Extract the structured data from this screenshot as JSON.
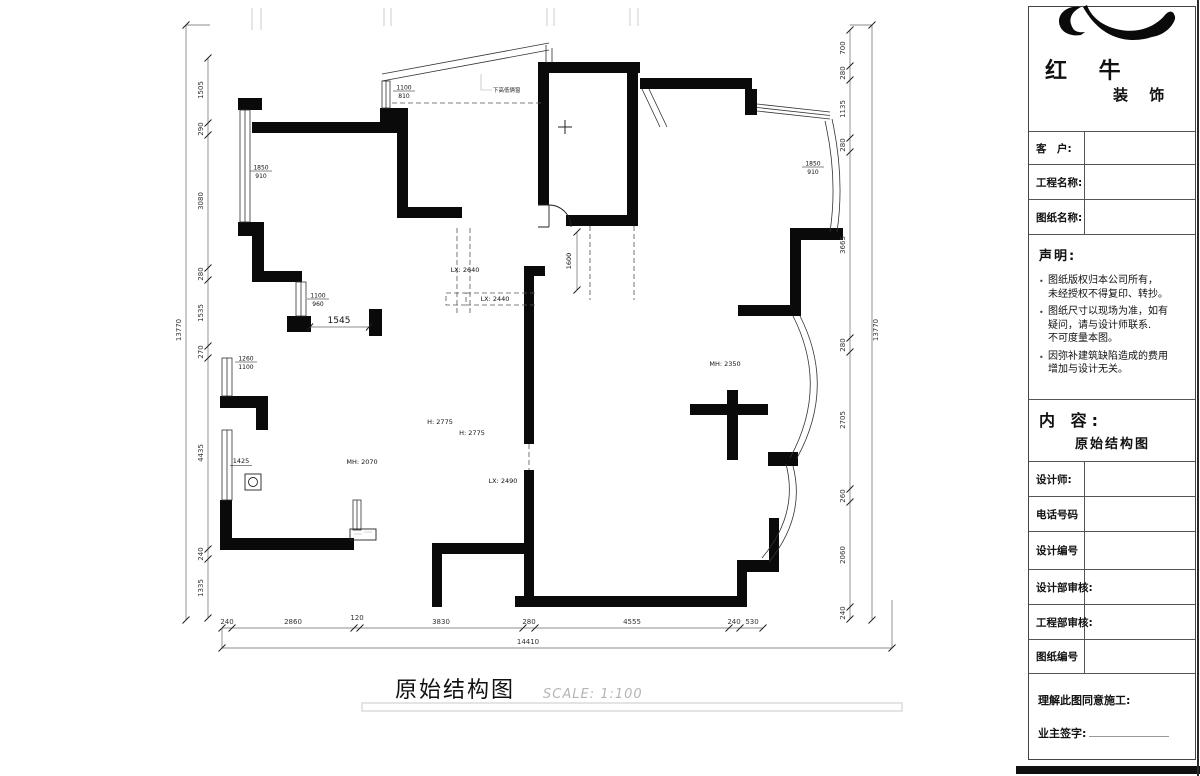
{
  "title_block": {
    "brand": {
      "name_line1": "红 牛",
      "name_line2": "装 饰"
    },
    "fields": [
      {
        "label": "客　户:"
      },
      {
        "label": "工程名称:"
      },
      {
        "label": "图纸名称:"
      }
    ],
    "statement": {
      "heading": "声明:",
      "items": [
        [
          "图纸版权归本公司所有，",
          "未经授权不得复印、转抄。"
        ],
        [
          "图纸尺寸以现场为准，如有",
          "疑问，请与设计师联系.",
          "不可度量本图。"
        ],
        [
          "因弥补建筑缺陷造成的费用",
          "增加与设计无关。"
        ]
      ]
    },
    "content": {
      "heading": "内 容:",
      "value": "原始结构图"
    },
    "rows": [
      {
        "label": "设计师:"
      },
      {
        "label": "电话号码"
      },
      {
        "label": "设计编号"
      },
      {
        "label": "设计部审核:"
      },
      {
        "label": "工程部审核:"
      },
      {
        "label": "图纸编号"
      }
    ],
    "footer": {
      "agree": "理解此图同意施工:",
      "sign": "业主签字:"
    }
  },
  "drawing": {
    "title": "原始结构图",
    "scale_note": "SCALE: 1:100",
    "dims": {
      "left_total": "13770",
      "left": [
        "1505",
        "290",
        "3080",
        "280",
        "1535",
        "270",
        "4435",
        "240",
        "1335"
      ],
      "right_total": "13770",
      "right": [
        "700",
        "280",
        "1135",
        "280",
        "3665",
        "280",
        "2705",
        "260",
        "2060",
        "240"
      ],
      "bottom_total": "14410",
      "bottom": [
        "240",
        "2860",
        "120",
        "3830",
        "280",
        "4555",
        "240",
        "530"
      ]
    },
    "annotations": {
      "win_left_top": {
        "num": "1850",
        "den": "910"
      },
      "win_right_top": {
        "num": "1850",
        "den": "910"
      },
      "win_bay": {
        "num": "1100",
        "den": "810"
      },
      "win_hall": {
        "num": "1100",
        "den": "960"
      },
      "win_kitchen_upper": {
        "num": "1260",
        "den": "1100"
      },
      "win_kitchen_lower": "1425",
      "dim_1545": "1545",
      "dim_1600": "1600",
      "beam_1": "LX: 2640",
      "beam_2": "LX: 2440",
      "beam_3": "LX: 2490",
      "height_1": "H: 2775",
      "height_2": "H: 2775",
      "door_height_1": "MH: 2070",
      "door_height_2": "MH: 2350",
      "note_small": "下高低俩窗"
    }
  }
}
